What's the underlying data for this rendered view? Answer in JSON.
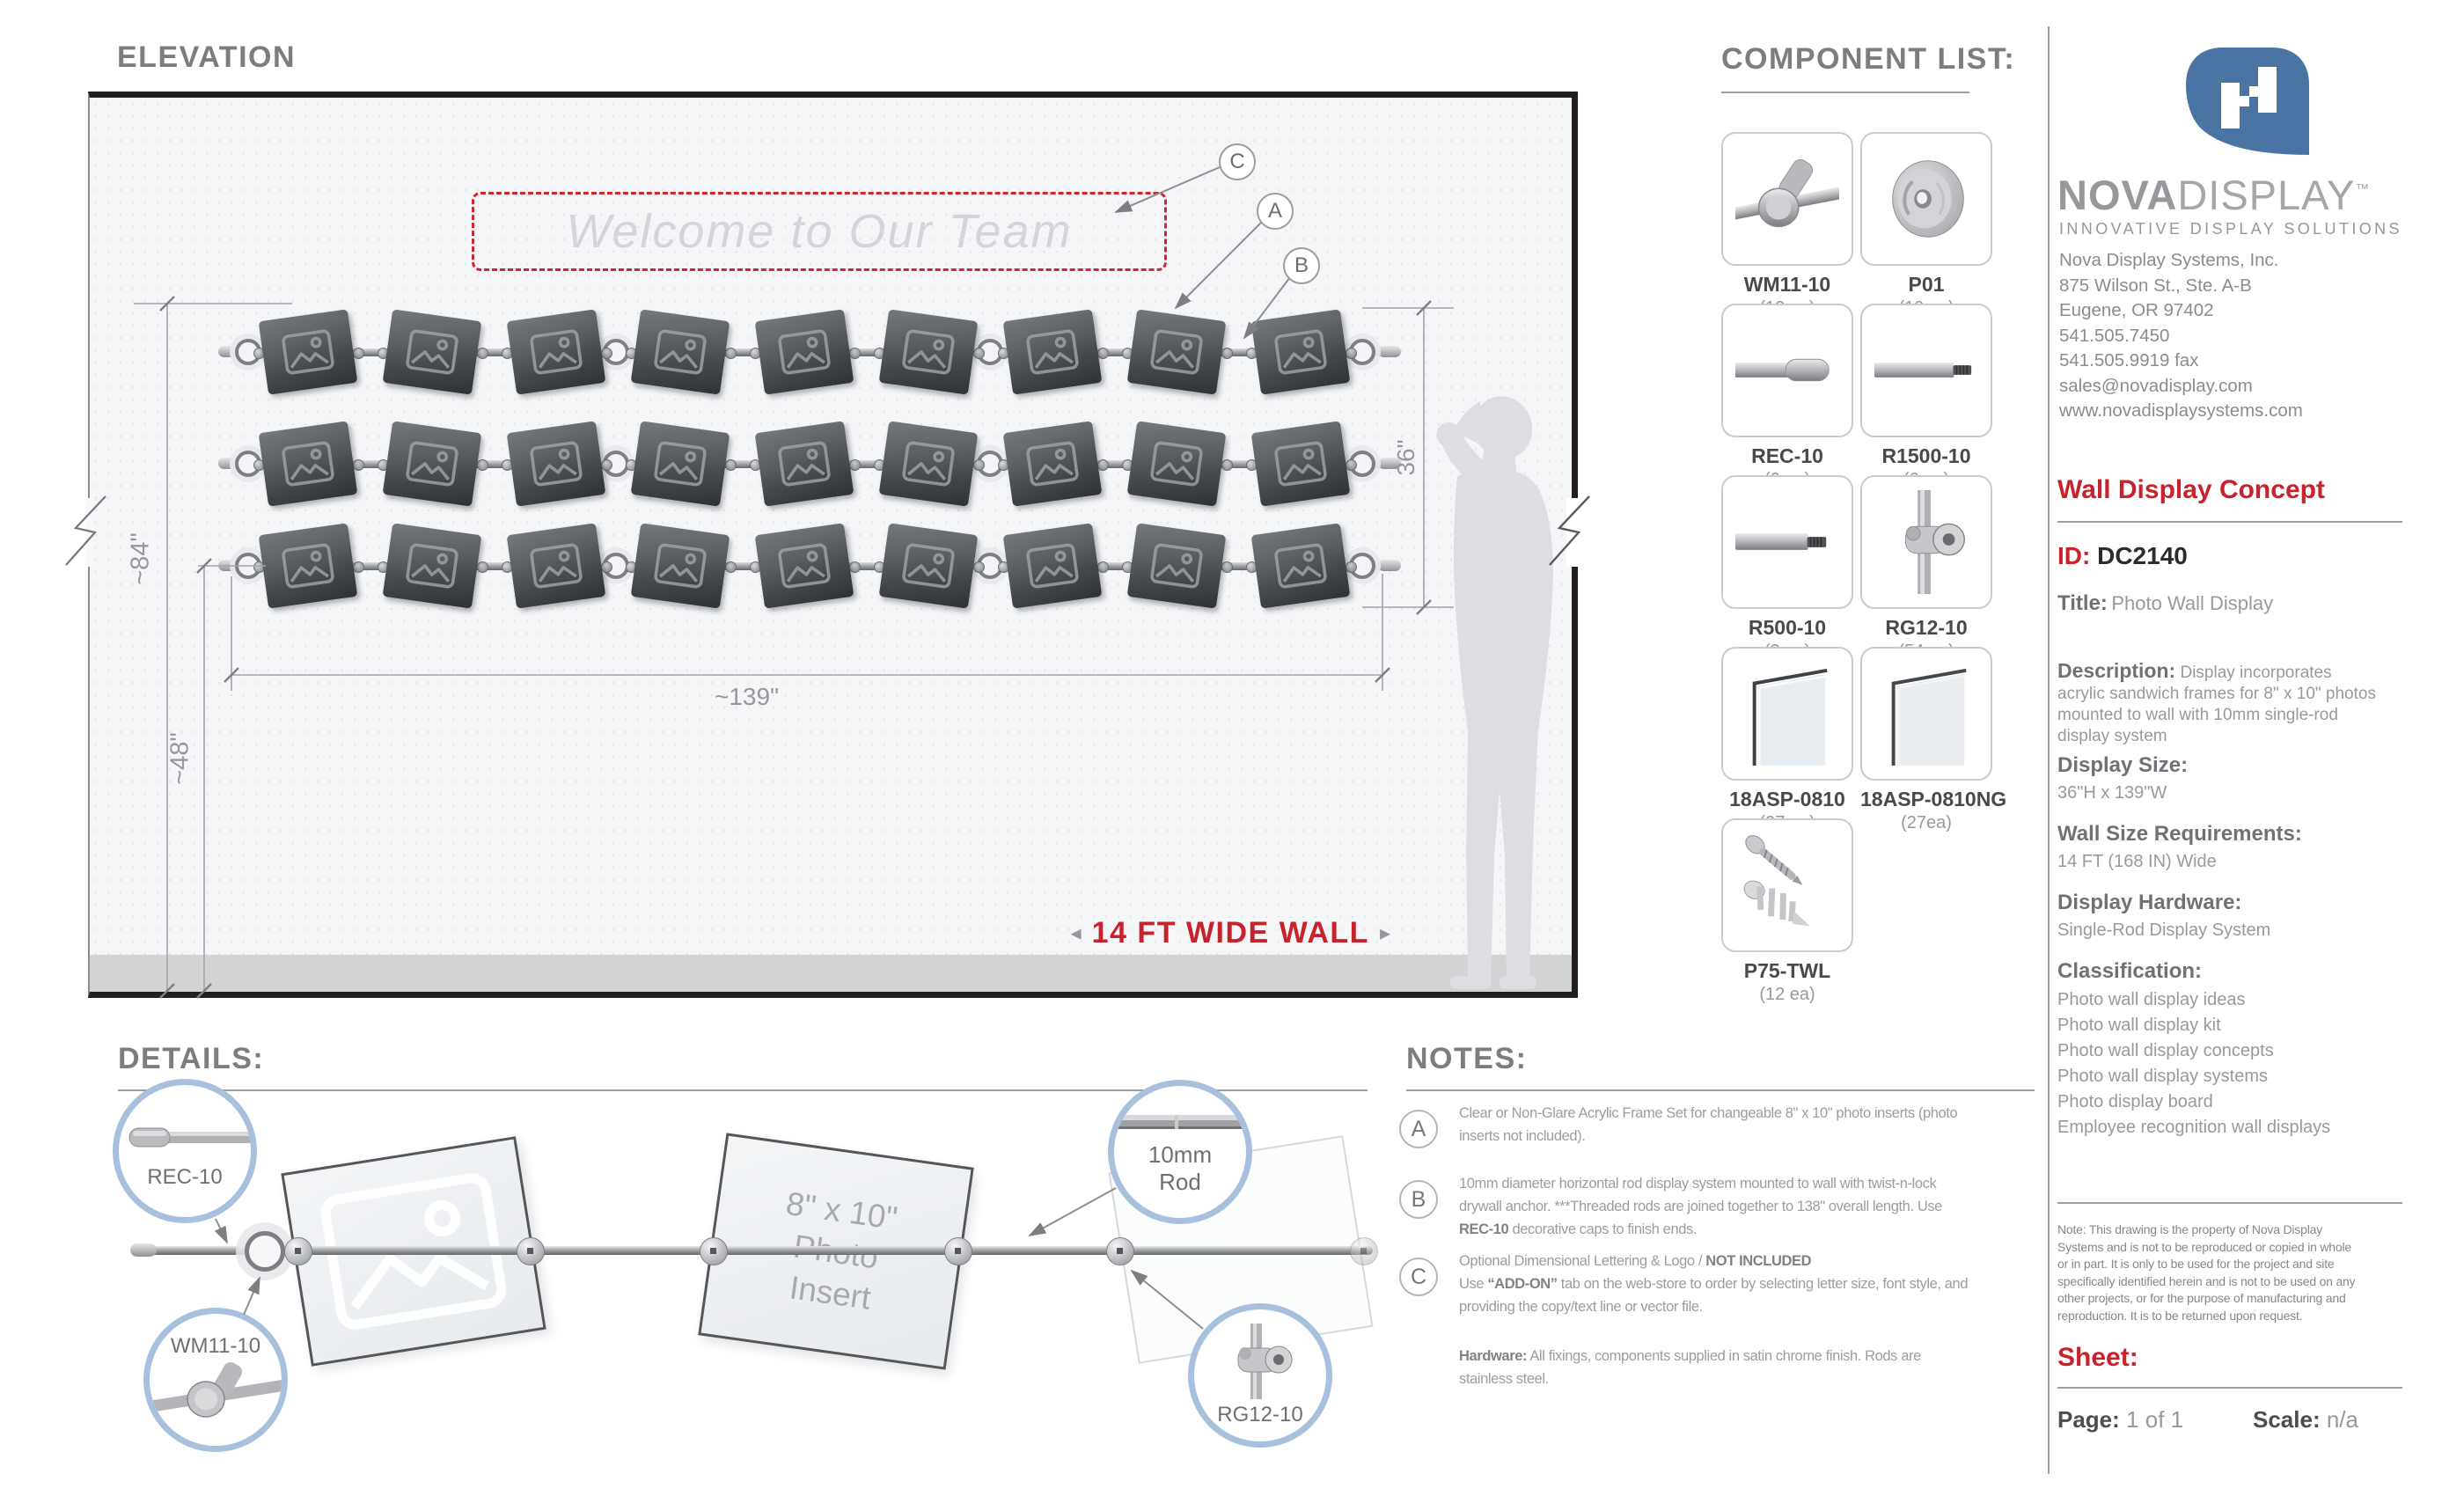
{
  "colors": {
    "accent_red": "#c8222c",
    "callout_blue": "#a6c0dd",
    "logo_blue": "#4a74a4"
  },
  "elevation": {
    "title": "ELEVATION",
    "welcome": "Welcome to Our Team",
    "wall_width": "14 FT WIDE WALL",
    "arrow_left": "◂",
    "arrow_right": "▸",
    "dim_overall_height": "~84\"",
    "dim_bottom_height": "~48\"",
    "dim_width": "~139\"",
    "dim_display_height": "36\"",
    "callout_c": "C",
    "callout_a": "A",
    "callout_b": "B"
  },
  "components": {
    "title": "COMPONENT LIST:",
    "items": [
      {
        "name": "WM11-10",
        "qty": "(12 ea)",
        "icon": "wall-mount"
      },
      {
        "name": "P01",
        "qty": "(12 ea)",
        "icon": "wall-plate"
      },
      {
        "name": "REC-10",
        "qty": "(6 ea)",
        "icon": "end-cap"
      },
      {
        "name": "R1500-10",
        "qty": "(6 ea)",
        "icon": "rod-long"
      },
      {
        "name": "R500-10",
        "qty": "(3 ea)",
        "icon": "rod-short"
      },
      {
        "name": "RG12-10",
        "qty": "(54 ea)",
        "icon": "rod-grip"
      },
      {
        "name": "18ASP-0810",
        "qty": "(27 ea)",
        "icon": "acrylic-clear"
      },
      {
        "name": "18ASP-0810NG",
        "qty": "(27ea)",
        "icon": "acrylic-nonglare"
      },
      {
        "name": "P75-TWL",
        "qty": "(12 ea)",
        "icon": "anchor-screw"
      }
    ]
  },
  "brand": {
    "name_bold": "NOVA",
    "name_light": "DISPLAY",
    "trademark": "™",
    "tagline": "INNOVATIVE DISPLAY SOLUTIONS",
    "address_lines": [
      "Nova Display Systems, Inc.",
      "875 Wilson St., Ste. A-B",
      "Eugene, OR 97402",
      "541.505.7450",
      "541.505.9919 fax",
      "sales@novadisplay.com",
      "www.novadisplaysystems.com"
    ]
  },
  "spec": {
    "heading": "Wall Display Concept",
    "id_label": "ID:",
    "id_value": "DC2140",
    "title_label": "Title:",
    "title_value": "Photo Wall Display",
    "description_label": "Description:",
    "description_value": "Display incorporates\nacrylic sandwich frames for 8\" x 10\" photos\nmounted to wall with 10mm single-rod\ndisplay system",
    "size_label": "Display Size:",
    "size_value": "36\"H x 139\"W",
    "wall_label": "Wall Size Requirements:",
    "wall_value": "14 FT (168 IN) Wide",
    "hardware_label": "Display Hardware:",
    "hardware_value": "Single-Rod Display System",
    "classification_label": "Classification:",
    "classification": [
      "Photo wall display ideas",
      "Photo wall display kit",
      "Photo wall display concepts",
      "Photo wall display systems",
      "Photo display board",
      "Employee recognition wall displays"
    ]
  },
  "legal": {
    "note": "Note: This drawing is the property of Nova Display\nSystems and is not to be reproduced or copied in whole\nor in part. It is only to be used for the project and site\nspecifically identified herein and is not to be used on any\nother projects, or for the purpose of manufacturing and\nreproduction. It is to be returned upon request.",
    "sheet_label": "Sheet:",
    "page_label": "Page:",
    "page_value": "1 of 1",
    "scale_label": "Scale:",
    "scale_value": "n/a"
  },
  "details": {
    "title": "DETAILS:",
    "callout_rec": "REC-10",
    "callout_wm": "WM11-10",
    "callout_rod_line1": "10mm",
    "callout_rod_line2": "Rod",
    "callout_rg": "RG12-10",
    "insert_lines": [
      "8\" x 10\"",
      "Photo",
      "Insert"
    ]
  },
  "notes": {
    "title": "NOTES:",
    "items": [
      {
        "letter": "A",
        "lines": [
          [
            {
              "t": "Clear or Non-Glare Acrylic Frame Set for changeable 8\" x 10\" photo inserts (photo"
            }
          ],
          [
            {
              "t": "inserts not included)."
            }
          ]
        ]
      },
      {
        "letter": "B",
        "lines": [
          [
            {
              "t": "10mm diameter horizontal rod display system mounted to wall with twist-n-lock"
            }
          ],
          [
            {
              "t": "drywall anchor. ***Threaded rods are joined together to 138\" overall length. Use"
            }
          ],
          [
            {
              "t": "REC-10",
              "b": true
            },
            {
              "t": " decorative caps to finish ends."
            }
          ]
        ]
      },
      {
        "letter": "C",
        "lines": [
          [
            {
              "t": "Optional Dimensional Lettering & Logo / "
            },
            {
              "t": "NOT INCLUDED",
              "b": true
            }
          ],
          [
            {
              "t": "Use "
            },
            {
              "t": "“ADD-ON”",
              "b": true
            },
            {
              "t": " tab on the web-store to order by selecting letter size, font style, and"
            }
          ],
          [
            {
              "t": "providing the copy/text line or vector file."
            }
          ]
        ]
      }
    ],
    "hardware_lines": [
      [
        {
          "t": "Hardware:",
          "b": true
        },
        {
          "t": " All fixings, components supplied in satin chrome finish. Rods are"
        }
      ],
      [
        {
          "t": "stainless steel."
        }
      ]
    ]
  }
}
